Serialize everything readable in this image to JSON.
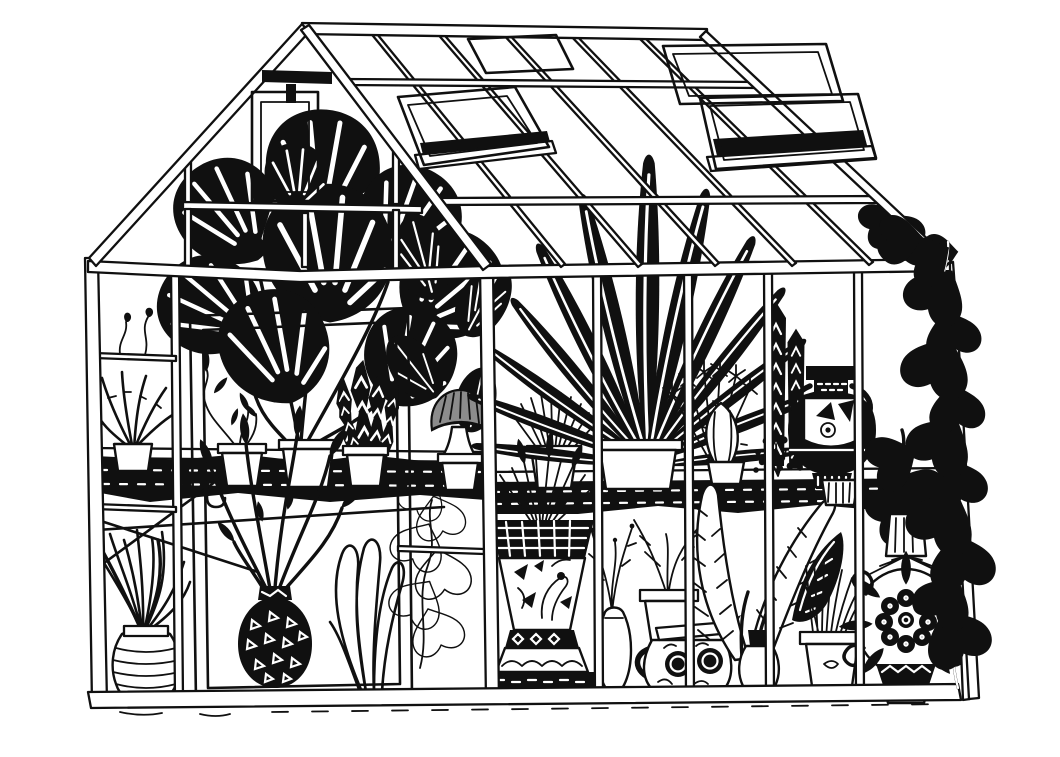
{
  "illustration": {
    "title": "Black and white pen-and-ink drawing of a glasshouse greenhouse packed with potted plants and decorative vases",
    "medium": "hand-drawn ink line art, black on white",
    "palette": {
      "paper": "#ffffff",
      "ink": "#101010",
      "hatch_gray": "#8c8c8c"
    },
    "elements": {
      "greenhouse": "glass greenhouse with gable end and long glazed wall",
      "roof": "sloped glass roof with glazing bars",
      "skylight_left": "open roof vent window, left",
      "skylight_right": "open roof vent window, right",
      "roof_pane": "flat closed roof pane near ridge",
      "apex_bracket": "dark iron bracket at gable apex",
      "gable": "triangular gable end with small window",
      "gable_window": "small rectangular gable window",
      "left_wall": "left glazed wall with framed door",
      "door": "tall double-framed greenhouse door",
      "door_hook": "small latch hook on door frame",
      "shelf_left": "dark cluttered plant shelf, left wall",
      "shelf_front": "dark cluttered plant shelf, front wall",
      "braces": "diagonal shelf braces",
      "base_rail": "timber base rail",
      "ground": "sketchy ground line",
      "corner_post": "corner post between walls",
      "right_wall": "right corner return with climbing vine",
      "monstera": "large monstera with split leaves",
      "prayer_plant": "striped prayer-plant leaves",
      "dracaena": "tall dracaena with sword leaves",
      "snake_plant": "sansevieria with zigzag leaves",
      "aloe": "spiky aloe in small pot",
      "seedling": "tiny sprouting seedling pane",
      "ivy_pot": "trailing ivy in terracotta pot",
      "mushroom_palm": "umbrella-shaped plant with grey hatched cap",
      "reed_pot": "fan of cut reeds in a pot",
      "papyrus": "thin-stemmed papyrus fan",
      "cactus": "ribbed oval cactus with spines",
      "fern_column": "dark chevron fern columns",
      "bush": "speckled dark baby's-breath bush",
      "greek_amphora": "black-figure Greek amphora with handles",
      "pothos_vine": "pothos vine with heart leaves climbing the corner",
      "spider_plant": "arching spider plant",
      "ribbed_vase": "round vase with horizontal ribs",
      "magnolia_branches": "budding magnolia branches",
      "triangle_vase": "black sphere vase with triangle pattern",
      "peace_lily": "outline peace-lily foliage",
      "climbing_pothos": "outline pothos climbing a pane",
      "chinoiserie_urn": "flared urn with bird pattern and scalloped foot",
      "bottle_vase": "slim bottle vase with dried sprigs",
      "twig_pot": "white pot with bare twigs",
      "paisley_pitcher": "jug with rosette medallions and loop handle",
      "tropical_leaves": "large veined tropical leaves in a vase",
      "grass_pot": "tuft of tall grass in a flower pot",
      "floral_vase": "round vase with carnation medallion and scrolls",
      "striped_pot": "small striped pot on the shelf"
    }
  }
}
